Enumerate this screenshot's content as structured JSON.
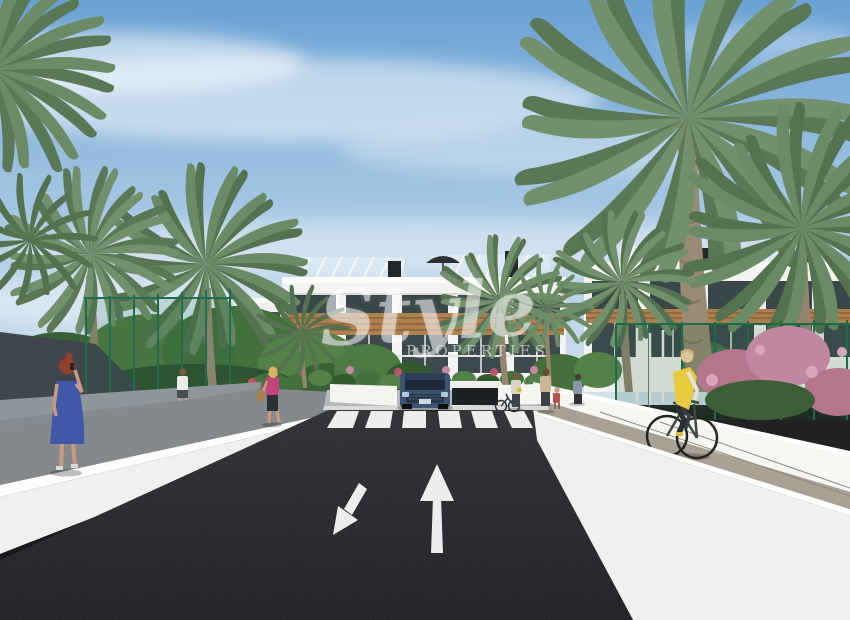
{
  "watermark": {
    "script": "Style",
    "caps": "PROPERTIES"
  },
  "palette": {
    "sky_top": "#6aa1d4",
    "sky_mid": "#a9c9e4",
    "sky_horizon": "#d3e3ee",
    "cloud_white": "#ffffff",
    "building_white": "#f3f4f1",
    "glass_dark": "#39464a",
    "wood_canopy": "#ad7f4e",
    "palm_green": "#6b8a66",
    "palm_green_dark": "#54724f",
    "tree_green": "#4e7a44",
    "tree_green_dark": "#35592f",
    "flower_pink": "#c287a0",
    "flower_red": "#b9556a",
    "fence_green": "#1e6b46",
    "asphalt_dark": "#212226",
    "road_marking_white": "#ededeb",
    "wall_white": "#f0f1ef",
    "wall_highlight": "#fdfdfb",
    "wall_base_dark": "#17181b",
    "path_gray": "#85898c",
    "retaining_gray": "#8f969b",
    "cobble_tan": "#a79f93",
    "plaza_gray": "#b5b9bb",
    "car_blue": "#3c5374",
    "vest_yellow": "#e9c93e",
    "dress_blue": "#3f58a8",
    "top_pink": "#c2457c",
    "shade_sail_gray": "#3f464c",
    "trunk_tan": "#9a8b75",
    "skin": "#c89a82"
  },
  "scene": {
    "setting": "new-build apartment complex exterior render with palm trees",
    "objects": [
      "sky",
      "clouds",
      "palm-trees",
      "apartment-buildings",
      "rooftop-pergolas",
      "roof-vents",
      "roof-parasol",
      "garage-entrance",
      "blue-suv",
      "asphalt-road",
      "zebra-crosswalk",
      "lane-arrows",
      "white-boundary-walls",
      "retaining-wall",
      "left-sidewalk",
      "bike-path",
      "planter-wall",
      "green-mesh-fence-left",
      "green-mesh-fence-right",
      "flowering-shrubs",
      "shade-sail",
      "woman-in-blue-dress-on-phone",
      "man-walking-away",
      "woman-in-pink-with-bag",
      "pedestrians-near-entrance",
      "woman-with-child",
      "cyclist-in-yellow-vest",
      "parked-bicycle"
    ],
    "road": {
      "crosswalk_stripe_count": 6,
      "lane_arrows": [
        "toward-viewer-down-left",
        "away-from-viewer-up"
      ]
    },
    "people_count": 10,
    "vehicles": [
      "blue-suv",
      "bicycle"
    ]
  }
}
